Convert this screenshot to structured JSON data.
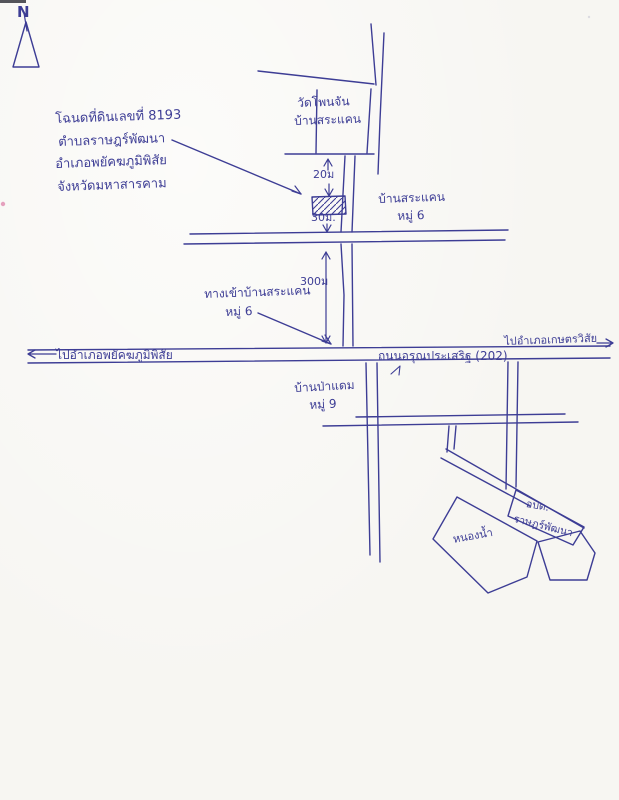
{
  "colors": {
    "ink": "#3d3d95",
    "paper": "#f7f6f2",
    "speck_pink": "#e08bb0"
  },
  "compass": {
    "label": "N"
  },
  "deed_note": {
    "line1": "โฉนดที่ดินเลขที่ 8193",
    "line2": "ตำบลราษฎร์พัฒนา",
    "line3": "อำเภอพยัคฆภูมิพิสัย",
    "line4": "จังหวัดมหาสารคาม"
  },
  "temple_block": {
    "line1": "วัดโพนจัน",
    "line2": "บ้านสระแคน"
  },
  "dimensions": {
    "above_plot": "20ม",
    "below_plot": "30ม.",
    "to_highway": "300ม"
  },
  "village_moo6": {
    "line1": "บ้านสระแคน",
    "line2": "หมู่ 6"
  },
  "entrance_note": {
    "line1": "ทางเข้าบ้านสระแคน",
    "line2": "หมู่ 6"
  },
  "highway": {
    "to_left": "ไปอำเภอพยัคฆภูมิพิสัย",
    "name": "ถนนอรุณประเสริฐ (202)",
    "to_right": "ไปอำเภอเกษตรวิสัย"
  },
  "village_moo9": {
    "line1": "บ้านป่าแดม",
    "line2": "หมู่ 9"
  },
  "sao_office": {
    "line1": "อบต.",
    "line2": "ราษฎร์พัฒนา"
  },
  "pond": {
    "label": "หนองน้ำ"
  }
}
